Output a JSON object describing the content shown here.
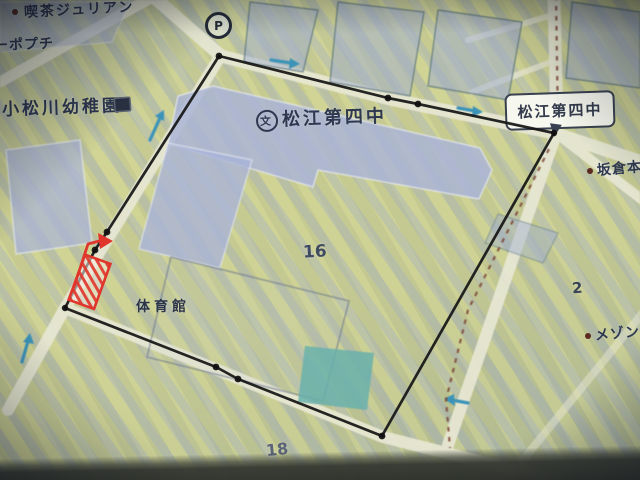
{
  "labels": {
    "cafe_julian": "喫茶ジュリアン",
    "popuchi": "ーポプチ",
    "kindergarten": "小松川幼稚園",
    "school_name": "松江第四中",
    "school_symbol": "文",
    "road_sign": "松江第四中",
    "gym": "体育館",
    "sakakura": "坂倉本",
    "maison": "メゾン",
    "parking_symbol": "P",
    "block_16": "16",
    "block_18": "18",
    "block_2": "2"
  },
  "colors": {
    "survey_line": "#151515",
    "marker_red": "#e0352b",
    "arrow_blue": "#3c93b8",
    "route_dash_brown": "#7b4636",
    "road_fill": "#e8e8d4",
    "building_fill": "#a9b3d8",
    "pool_teal": "#68b0ac",
    "ground_yellow": "#c7cb8e",
    "label_text": "#2e3850"
  }
}
